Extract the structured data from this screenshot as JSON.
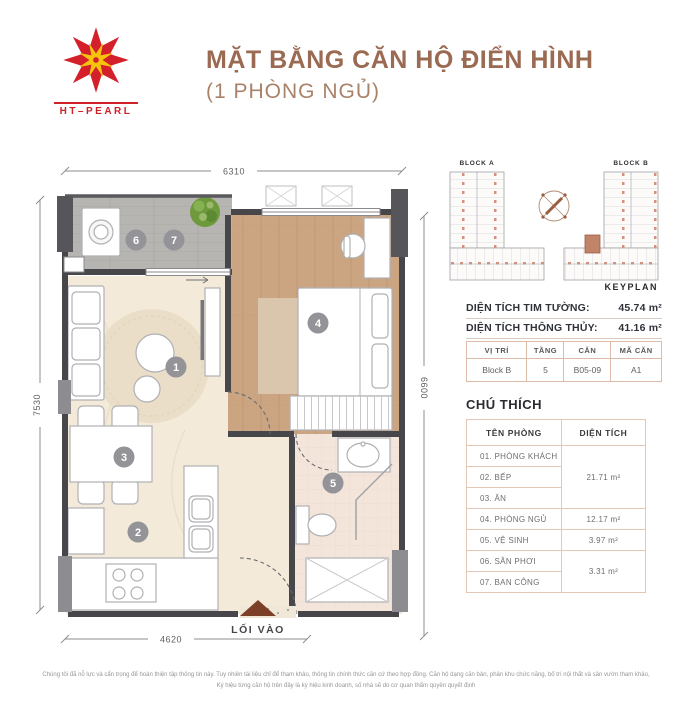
{
  "header": {
    "logo_text": "HT–PEARL",
    "title": "MẶT BẰNG CĂN HỘ ĐIỂN HÌNH",
    "subtitle": "(1 PHÒNG NGỦ)"
  },
  "keyplan": {
    "block_a": "BLOCK A",
    "block_b": "BLOCK B",
    "label": "KEYPLAN"
  },
  "areas": {
    "gross_label": "DIỆN TÍCH TIM TƯỜNG:",
    "gross_value": "45.74 m²",
    "net_label": "DIỆN TÍCH THÔNG THỦY:",
    "net_value": "41.16 m²"
  },
  "unit_table": {
    "headers": [
      "VỊ TRÍ",
      "TẦNG",
      "CĂN",
      "MÃ CĂN"
    ],
    "row": [
      "Block B",
      "5",
      "B05-09",
      "A1"
    ]
  },
  "legend": {
    "title": "CHÚ THÍCH",
    "headers": [
      "TÊN PHÒNG",
      "DIỆN TÍCH"
    ],
    "rooms": [
      "01. PHÒNG KHÁCH",
      "02. BẾP",
      "03. ĂN",
      "04. PHÒNG NGỦ",
      "05. VỆ SINH",
      "06. SÂN PHƠI",
      "07. BAN CÔNG"
    ],
    "area_groups": [
      {
        "rows": [
          0,
          1,
          2
        ],
        "value": "21.71 m²"
      },
      {
        "rows": [
          3
        ],
        "value": "12.17 m²"
      },
      {
        "rows": [
          4
        ],
        "value": "3.97 m²"
      },
      {
        "rows": [
          5,
          6
        ],
        "value": "3.31 m²"
      }
    ]
  },
  "plan": {
    "dims": {
      "top": "6310",
      "left": "7530",
      "right": "6600",
      "bottom": "4620"
    },
    "entry_label": "LỐI VÀO",
    "markers": [
      "1",
      "2",
      "3",
      "4",
      "5",
      "6",
      "7"
    ]
  },
  "footer": {
    "line1": "Chúng tôi đã nỗ lực và cẩn trọng để hoàn thiện tập thông tin này. Tuy nhiên tài liệu chỉ để tham khảo, thông tin chính thức căn cứ theo hợp đồng. Căn hộ dạng căn bản, phân khu chức năng, bố trí nội thất và sân vườn tham khảo,",
    "line2": "Ký hiệu từng căn hộ trên đây là ký hiệu kinh doanh, số nhà sẽ do cơ quan thẩm quyền quyết định"
  },
  "colors": {
    "title_brown": "#9b6a52",
    "logo_red": "#d4202a",
    "logo_yellow": "#f6c40e",
    "wall": "#47474b",
    "wood_floor": "#cba581",
    "cream_floor": "#f4ead9",
    "balcony_floor": "#b7b5b2",
    "bath_floor": "#f4e5db",
    "highlight_unit": "#c28468",
    "table_border": "#e5c7b5",
    "entry_arrow": "#7c4028"
  }
}
